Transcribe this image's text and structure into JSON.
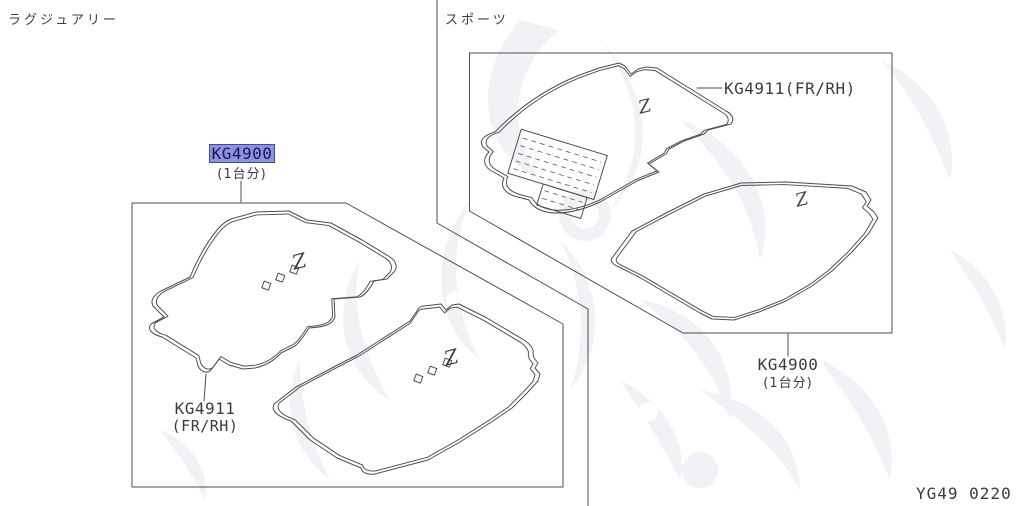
{
  "diagram_code": "YG49 0220",
  "emblem_glyph": "Z",
  "colors": {
    "line": "#4d4d4d",
    "text": "#3b3b3b",
    "highlight_bg": "#8e93de",
    "highlight_border": "#4045b4",
    "highlight_text": "#16164f",
    "watermark": "#ededf3"
  },
  "sections": {
    "luxury": {
      "title": "ラグジュアリー",
      "set_part": {
        "code": "KG4900",
        "qty_note": "(1台分)",
        "highlighted": true
      },
      "front_part": {
        "code": "KG4911",
        "position_note": "(FR/RH)"
      }
    },
    "sport": {
      "title": "スポーツ",
      "front_part": {
        "label": "KG4911(FR/RH)"
      },
      "set_part": {
        "code": "KG4900",
        "qty_note": "(1台分)"
      }
    }
  }
}
